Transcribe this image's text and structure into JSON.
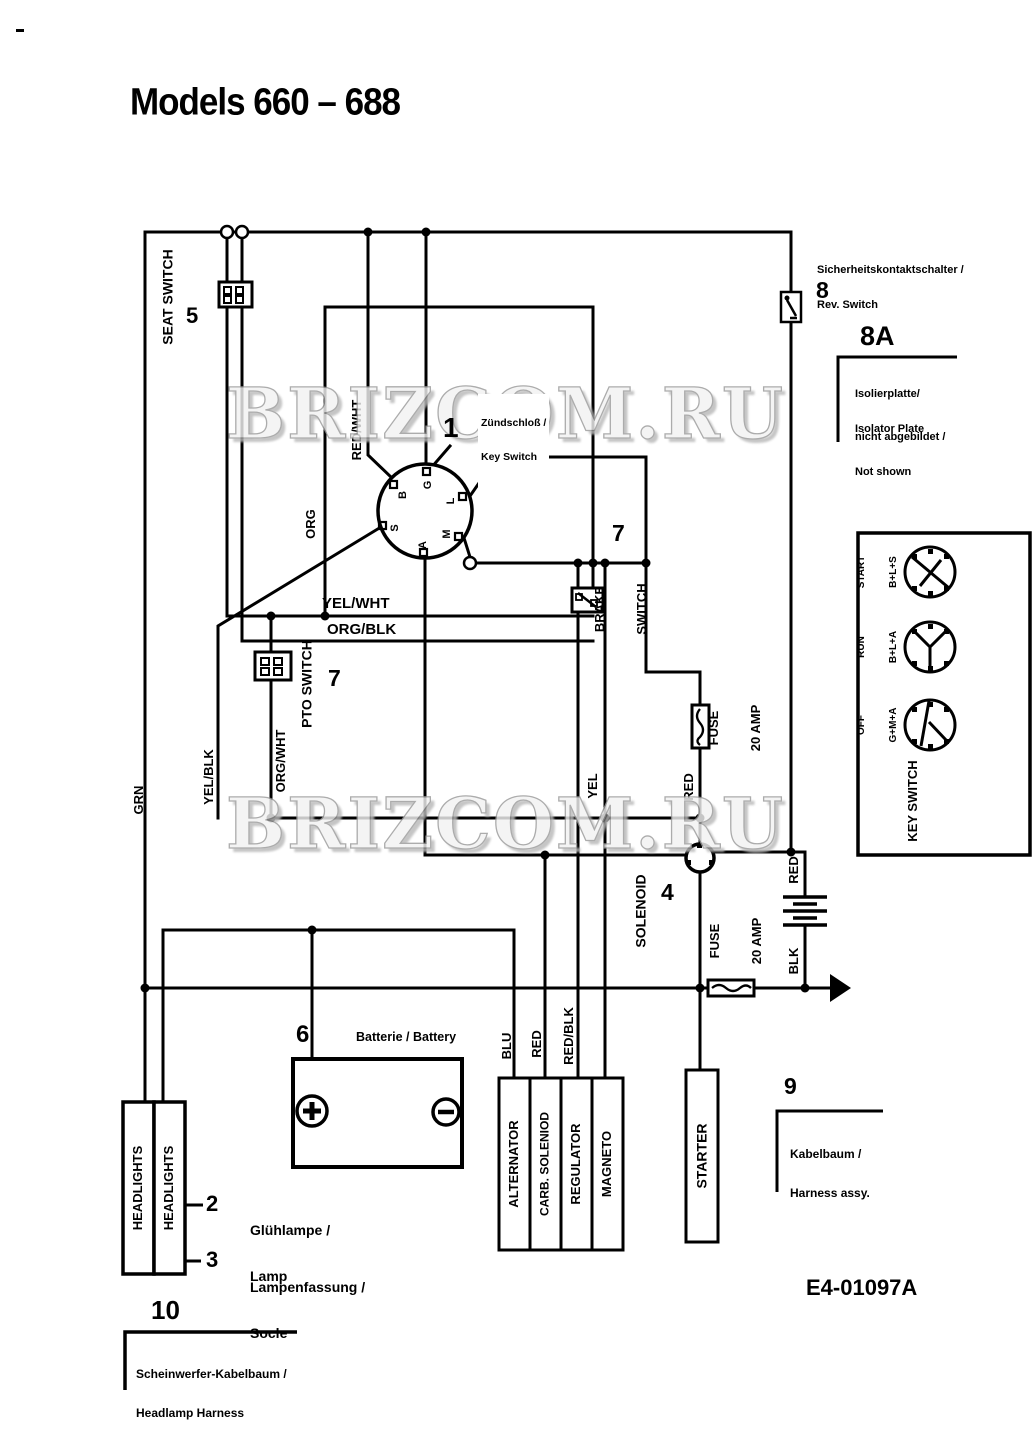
{
  "page": {
    "title": "Models 660 – 688",
    "part_number": "E4-01097A",
    "watermark": "BRIZCOM.RU"
  },
  "components": {
    "seat_switch": {
      "label": "SEAT SWITCH",
      "number": "5"
    },
    "key_switch": {
      "number": "1",
      "caption_line1": "Zündschloß /",
      "caption_line2": "Key Switch",
      "terminals": {
        "g": "G",
        "b": "B",
        "l": "L",
        "s": "S",
        "m": "M",
        "a": "A"
      }
    },
    "rev_switch": {
      "number": "8",
      "caption_line1": "Sicherheitskontaktschalter /",
      "caption_line2": "Rev. Switch"
    },
    "isolator_plate_note": {
      "number": "8A",
      "de": "Isolierplatte/",
      "en": "Isolator Plate",
      "note_de": "nicht abgebildet /",
      "note_en": "Not shown"
    },
    "brake_switch": {
      "number": "7",
      "label_line1": "BRAKE",
      "label_line2": "SWITCH"
    },
    "pto_switch": {
      "number": "7",
      "label": "PTO SWITCH"
    },
    "solenoid": {
      "number": "4",
      "label": "SOLENOID"
    },
    "fuse_upper": {
      "line1": "FUSE",
      "line2": "20 AMP"
    },
    "fuse_lower": {
      "line1": "FUSE",
      "line2": "20 AMP"
    },
    "battery": {
      "number": "6",
      "caption": "Batterie / Battery",
      "plus": "+",
      "minus": "−"
    },
    "starter": {
      "label": "STARTER"
    },
    "engine_components": [
      "ALTERNATOR",
      "CARB. SOLENIOD",
      "REGULATOR",
      "MAGNETO"
    ],
    "headlights": {
      "left": "HEADLIGHTS",
      "right": "HEADLIGHTS"
    }
  },
  "key_positions_panel": {
    "label": "KEY SWITCH",
    "positions": [
      {
        "name": "START",
        "contacts": "B+L+S"
      },
      {
        "name": "RUN",
        "contacts": "B+L+A"
      },
      {
        "name": "OFF",
        "contacts": "G+M+A"
      }
    ]
  },
  "callouts": {
    "lamp": {
      "number": "2",
      "de": "Glühlampe /",
      "en": "Lamp"
    },
    "socket": {
      "number": "3",
      "de": "Lampenfassung /",
      "en": "Socle"
    },
    "harness": {
      "number": "9",
      "de": "Kabelbaum /",
      "en": "Harness assy."
    },
    "headlamp_harness": {
      "number": "10",
      "de": "Scheinwerfer-Kabelbaum /",
      "en": "Headlamp Harness"
    }
  },
  "wire_labels": {
    "grn": "GRN",
    "yel_blk": "YEL/BLK",
    "org_wht": "ORG/WHT",
    "org": "ORG",
    "red_wht": "RED/WHT",
    "yel_wht": "YEL/WHT",
    "org_blk": "ORG/BLK",
    "yel": "YEL",
    "red_fuse": "RED",
    "red_battery": "RED",
    "blk": "BLK",
    "blu": "BLU",
    "red_carb": "RED",
    "red_blk": "RED/BLK"
  }
}
